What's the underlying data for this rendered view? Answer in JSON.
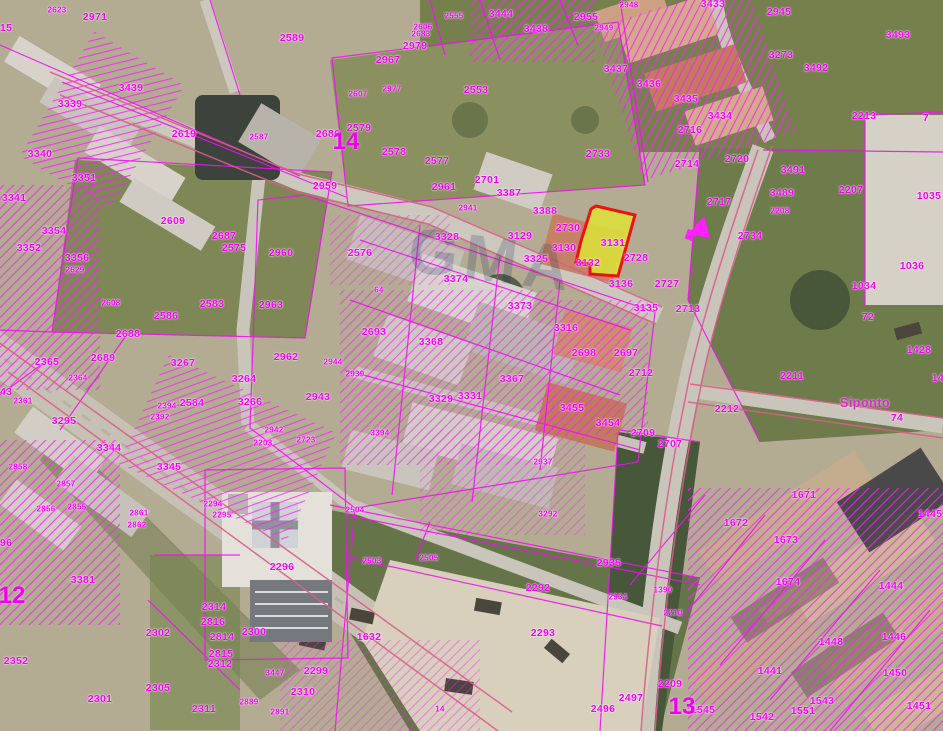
{
  "map": {
    "type": "cadastral-parcel-overlay-on-aerial-photo",
    "street_label": "Siponto",
    "watermark": "GMA",
    "highlight_parcel": {
      "number": "3131",
      "fill": "#dce03a",
      "border": "#ee1111"
    },
    "colors": {
      "parcel_line": "#ef12ef",
      "road_edge_line": "#d85f88",
      "label_text": "#f700f7",
      "street_label_text": "#d929c9",
      "sheet_number_text": "#ef00ef",
      "highlight_fill": "#dce03a",
      "highlight_border": "#ee1111"
    },
    "sheet_numbers": [
      {
        "t": "14",
        "x": 346,
        "y": 142
      },
      {
        "t": "12",
        "x": 12,
        "y": 596
      },
      {
        "t": "13",
        "x": 682,
        "y": 707
      }
    ],
    "street_labels": [
      {
        "t": "Siponto",
        "x": 865,
        "y": 403
      }
    ],
    "labels": [
      {
        "t": "2623",
        "x": 57,
        "y": 10,
        "s": 1
      },
      {
        "t": "2971",
        "x": 95,
        "y": 17
      },
      {
        "t": "2615",
        "x": 0,
        "y": 28
      },
      {
        "t": "2589",
        "x": 292,
        "y": 38
      },
      {
        "t": "3439",
        "x": 131,
        "y": 88
      },
      {
        "t": "3339",
        "x": 70,
        "y": 104
      },
      {
        "t": "3340",
        "x": 40,
        "y": 154
      },
      {
        "t": "2619",
        "x": 184,
        "y": 134
      },
      {
        "t": "2587",
        "x": 259,
        "y": 137,
        "s": 1
      },
      {
        "t": "3351",
        "x": 84,
        "y": 178
      },
      {
        "t": "3341",
        "x": 14,
        "y": 198
      },
      {
        "t": "3354",
        "x": 54,
        "y": 231
      },
      {
        "t": "3352",
        "x": 29,
        "y": 248
      },
      {
        "t": "3356",
        "x": 77,
        "y": 258
      },
      {
        "t": "2629",
        "x": 75,
        "y": 270,
        "s": 1
      },
      {
        "t": "2608",
        "x": 111,
        "y": 303,
        "s": 1
      },
      {
        "t": "2609",
        "x": 173,
        "y": 221
      },
      {
        "t": "2687",
        "x": 224,
        "y": 236
      },
      {
        "t": "2575",
        "x": 234,
        "y": 248
      },
      {
        "t": "2960",
        "x": 281,
        "y": 253
      },
      {
        "t": "2583",
        "x": 212,
        "y": 304
      },
      {
        "t": "2963",
        "x": 271,
        "y": 305
      },
      {
        "t": "2586",
        "x": 166,
        "y": 316
      },
      {
        "t": "2576",
        "x": 360,
        "y": 253
      },
      {
        "t": "2688",
        "x": 128,
        "y": 334
      },
      {
        "t": "2689",
        "x": 103,
        "y": 358
      },
      {
        "t": "2365",
        "x": 47,
        "y": 362
      },
      {
        "t": "3267",
        "x": 183,
        "y": 363
      },
      {
        "t": "2962",
        "x": 286,
        "y": 357
      },
      {
        "t": "3264",
        "x": 244,
        "y": 379
      },
      {
        "t": "3266",
        "x": 250,
        "y": 402
      },
      {
        "t": "2584",
        "x": 192,
        "y": 403
      },
      {
        "t": "2364",
        "x": 78,
        "y": 378,
        "s": 1
      },
      {
        "t": "3443",
        "x": 0,
        "y": 392
      },
      {
        "t": "2361",
        "x": 23,
        "y": 401,
        "s": 1
      },
      {
        "t": "3295",
        "x": 64,
        "y": 421
      },
      {
        "t": "2394",
        "x": 167,
        "y": 406,
        "s": 1
      },
      {
        "t": "2392",
        "x": 160,
        "y": 417,
        "s": 1
      },
      {
        "t": "3344",
        "x": 109,
        "y": 448
      },
      {
        "t": "3345",
        "x": 169,
        "y": 467
      },
      {
        "t": "2942",
        "x": 274,
        "y": 430,
        "s": 1
      },
      {
        "t": "2723",
        "x": 306,
        "y": 440,
        "s": 1
      },
      {
        "t": "2203",
        "x": 263,
        "y": 443,
        "s": 1
      },
      {
        "t": "2858",
        "x": 18,
        "y": 467,
        "s": 1
      },
      {
        "t": "2857",
        "x": 66,
        "y": 484,
        "s": 1
      },
      {
        "t": "2855",
        "x": 77,
        "y": 507,
        "s": 1
      },
      {
        "t": "2856",
        "x": 46,
        "y": 509,
        "s": 1
      },
      {
        "t": "2861",
        "x": 139,
        "y": 513,
        "s": 1
      },
      {
        "t": "2862",
        "x": 137,
        "y": 525,
        "s": 1
      },
      {
        "t": "2294",
        "x": 213,
        "y": 504,
        "s": 1
      },
      {
        "t": "2295",
        "x": 222,
        "y": 515,
        "s": 1
      },
      {
        "t": "3296",
        "x": 0,
        "y": 543
      },
      {
        "t": "3381",
        "x": 83,
        "y": 580
      },
      {
        "t": "2296",
        "x": 282,
        "y": 567
      },
      {
        "t": "2352",
        "x": 16,
        "y": 661
      },
      {
        "t": "2301",
        "x": 100,
        "y": 699
      },
      {
        "t": "2302",
        "x": 158,
        "y": 633
      },
      {
        "t": "2305",
        "x": 158,
        "y": 688
      },
      {
        "t": "2314",
        "x": 214,
        "y": 607
      },
      {
        "t": "2816",
        "x": 213,
        "y": 622
      },
      {
        "t": "2814",
        "x": 222,
        "y": 637
      },
      {
        "t": "2300",
        "x": 254,
        "y": 632
      },
      {
        "t": "2815",
        "x": 221,
        "y": 654
      },
      {
        "t": "2312",
        "x": 220,
        "y": 664
      },
      {
        "t": "3447",
        "x": 275,
        "y": 673,
        "s": 1
      },
      {
        "t": "2299",
        "x": 316,
        "y": 671
      },
      {
        "t": "2310",
        "x": 303,
        "y": 692
      },
      {
        "t": "2311",
        "x": 204,
        "y": 709
      },
      {
        "t": "2889",
        "x": 249,
        "y": 702,
        "s": 1
      },
      {
        "t": "2891",
        "x": 280,
        "y": 712,
        "s": 1
      },
      {
        "t": "2504",
        "x": 355,
        "y": 510,
        "s": 1
      },
      {
        "t": "2503",
        "x": 372,
        "y": 561,
        "s": 1
      },
      {
        "t": "2505",
        "x": 429,
        "y": 558,
        "s": 1
      },
      {
        "t": "3292",
        "x": 548,
        "y": 514,
        "s": 1
      },
      {
        "t": "2935",
        "x": 609,
        "y": 563
      },
      {
        "t": "2292",
        "x": 538,
        "y": 588
      },
      {
        "t": "2934",
        "x": 618,
        "y": 597,
        "s": 1
      },
      {
        "t": "2293",
        "x": 543,
        "y": 633
      },
      {
        "t": "1632",
        "x": 369,
        "y": 637
      },
      {
        "t": "14",
        "x": 440,
        "y": 709,
        "s": 1
      },
      {
        "t": "2497",
        "x": 631,
        "y": 698
      },
      {
        "t": "2496",
        "x": 603,
        "y": 709
      },
      {
        "t": "2209",
        "x": 670,
        "y": 684
      },
      {
        "t": "2210",
        "x": 673,
        "y": 613,
        "s": 1
      },
      {
        "t": "1390",
        "x": 663,
        "y": 590,
        "s": 1
      },
      {
        "t": "1545",
        "x": 703,
        "y": 710
      },
      {
        "t": "1542",
        "x": 762,
        "y": 717
      },
      {
        "t": "1551",
        "x": 803,
        "y": 711
      },
      {
        "t": "1543",
        "x": 822,
        "y": 701
      },
      {
        "t": "1451",
        "x": 919,
        "y": 706
      },
      {
        "t": "1450",
        "x": 895,
        "y": 673
      },
      {
        "t": "1446",
        "x": 894,
        "y": 637
      },
      {
        "t": "1448",
        "x": 831,
        "y": 642
      },
      {
        "t": "1444",
        "x": 891,
        "y": 586
      },
      {
        "t": "1445",
        "x": 930,
        "y": 514
      },
      {
        "t": "1441",
        "x": 770,
        "y": 671
      },
      {
        "t": "1671",
        "x": 804,
        "y": 495
      },
      {
        "t": "1672",
        "x": 736,
        "y": 523
      },
      {
        "t": "1673",
        "x": 786,
        "y": 540
      },
      {
        "t": "1674",
        "x": 788,
        "y": 582
      },
      {
        "t": "1428",
        "x": 919,
        "y": 350
      },
      {
        "t": "143",
        "x": 941,
        "y": 378
      },
      {
        "t": "2712",
        "x": 641,
        "y": 373
      },
      {
        "t": "2211",
        "x": 792,
        "y": 376
      },
      {
        "t": "2212",
        "x": 727,
        "y": 409
      },
      {
        "t": "2709",
        "x": 643,
        "y": 433
      },
      {
        "t": "2707",
        "x": 670,
        "y": 444
      },
      {
        "t": "74",
        "x": 897,
        "y": 418
      },
      {
        "t": "72",
        "x": 868,
        "y": 317
      },
      {
        "t": "1034",
        "x": 864,
        "y": 286
      },
      {
        "t": "1036",
        "x": 912,
        "y": 266
      },
      {
        "t": "1035",
        "x": 929,
        "y": 196
      },
      {
        "t": "2207",
        "x": 851,
        "y": 190
      },
      {
        "t": "2208",
        "x": 780,
        "y": 211,
        "s": 1
      },
      {
        "t": "3489",
        "x": 782,
        "y": 193
      },
      {
        "t": "3491",
        "x": 793,
        "y": 170
      },
      {
        "t": "2734",
        "x": 750,
        "y": 236
      },
      {
        "t": "2717",
        "x": 719,
        "y": 202
      },
      {
        "t": "2720",
        "x": 737,
        "y": 159
      },
      {
        "t": "2714",
        "x": 687,
        "y": 164
      },
      {
        "t": "2716",
        "x": 690,
        "y": 130
      },
      {
        "t": "3434",
        "x": 720,
        "y": 116
      },
      {
        "t": "3435",
        "x": 686,
        "y": 99
      },
      {
        "t": "3436",
        "x": 649,
        "y": 84
      },
      {
        "t": "3433",
        "x": 713,
        "y": 4
      },
      {
        "t": "2945",
        "x": 779,
        "y": 12
      },
      {
        "t": "3273",
        "x": 781,
        "y": 55
      },
      {
        "t": "3492",
        "x": 816,
        "y": 68
      },
      {
        "t": "3493",
        "x": 898,
        "y": 35
      },
      {
        "t": "2213",
        "x": 864,
        "y": 116
      },
      {
        "t": "7",
        "x": 926,
        "y": 118
      },
      {
        "t": "2733",
        "x": 598,
        "y": 154
      },
      {
        "t": "2955",
        "x": 586,
        "y": 17
      },
      {
        "t": "2948",
        "x": 629,
        "y": 5,
        "s": 1
      },
      {
        "t": "2949",
        "x": 604,
        "y": 28,
        "s": 1
      },
      {
        "t": "3437",
        "x": 616,
        "y": 69
      },
      {
        "t": "3438",
        "x": 536,
        "y": 29
      },
      {
        "t": "3444",
        "x": 501,
        "y": 14
      },
      {
        "t": "2555",
        "x": 454,
        "y": 16,
        "s": 1
      },
      {
        "t": "2606",
        "x": 423,
        "y": 27,
        "s": 1
      },
      {
        "t": "2683",
        "x": 421,
        "y": 34,
        "s": 1
      },
      {
        "t": "2979",
        "x": 415,
        "y": 46
      },
      {
        "t": "2967",
        "x": 388,
        "y": 60
      },
      {
        "t": "2977",
        "x": 392,
        "y": 89,
        "s": 1
      },
      {
        "t": "2607",
        "x": 358,
        "y": 94,
        "s": 1
      },
      {
        "t": "2553",
        "x": 476,
        "y": 90
      },
      {
        "t": "2579",
        "x": 359,
        "y": 128
      },
      {
        "t": "2686",
        "x": 328,
        "y": 134
      },
      {
        "t": "2578",
        "x": 394,
        "y": 152
      },
      {
        "t": "2577",
        "x": 437,
        "y": 161
      },
      {
        "t": "2701",
        "x": 487,
        "y": 180
      },
      {
        "t": "2959",
        "x": 325,
        "y": 186
      },
      {
        "t": "2961",
        "x": 444,
        "y": 187
      },
      {
        "t": "3387",
        "x": 509,
        "y": 193
      },
      {
        "t": "2941",
        "x": 468,
        "y": 208,
        "s": 1
      },
      {
        "t": "3388",
        "x": 545,
        "y": 211
      },
      {
        "t": "3129",
        "x": 520,
        "y": 236
      },
      {
        "t": "2730",
        "x": 568,
        "y": 228
      },
      {
        "t": "3130",
        "x": 564,
        "y": 248
      },
      {
        "t": "3325",
        "x": 536,
        "y": 259
      },
      {
        "t": "3328",
        "x": 447,
        "y": 237
      },
      {
        "t": "3374",
        "x": 456,
        "y": 279
      },
      {
        "t": "64",
        "x": 379,
        "y": 290,
        "s": 1
      },
      {
        "t": "3373",
        "x": 520,
        "y": 306
      },
      {
        "t": "3316",
        "x": 566,
        "y": 328
      },
      {
        "t": "2693",
        "x": 374,
        "y": 332
      },
      {
        "t": "3368",
        "x": 431,
        "y": 342
      },
      {
        "t": "2698",
        "x": 584,
        "y": 353
      },
      {
        "t": "2697",
        "x": 626,
        "y": 353
      },
      {
        "t": "2944",
        "x": 333,
        "y": 362,
        "s": 1
      },
      {
        "t": "2939",
        "x": 355,
        "y": 374,
        "s": 1
      },
      {
        "t": "2943",
        "x": 318,
        "y": 397
      },
      {
        "t": "3329",
        "x": 441,
        "y": 399
      },
      {
        "t": "3331",
        "x": 470,
        "y": 396
      },
      {
        "t": "3367",
        "x": 512,
        "y": 379
      },
      {
        "t": "3455",
        "x": 572,
        "y": 408
      },
      {
        "t": "3454",
        "x": 608,
        "y": 423
      },
      {
        "t": "3394",
        "x": 380,
        "y": 433,
        "s": 1
      },
      {
        "t": "2937",
        "x": 543,
        "y": 462,
        "s": 1
      },
      {
        "t": "3131",
        "x": 613,
        "y": 243
      },
      {
        "t": "3132",
        "x": 588,
        "y": 263
      },
      {
        "t": "2728",
        "x": 636,
        "y": 258
      },
      {
        "t": "3136",
        "x": 621,
        "y": 284
      },
      {
        "t": "2727",
        "x": 667,
        "y": 284
      },
      {
        "t": "3135",
        "x": 646,
        "y": 308
      },
      {
        "t": "2713",
        "x": 688,
        "y": 309
      }
    ]
  }
}
